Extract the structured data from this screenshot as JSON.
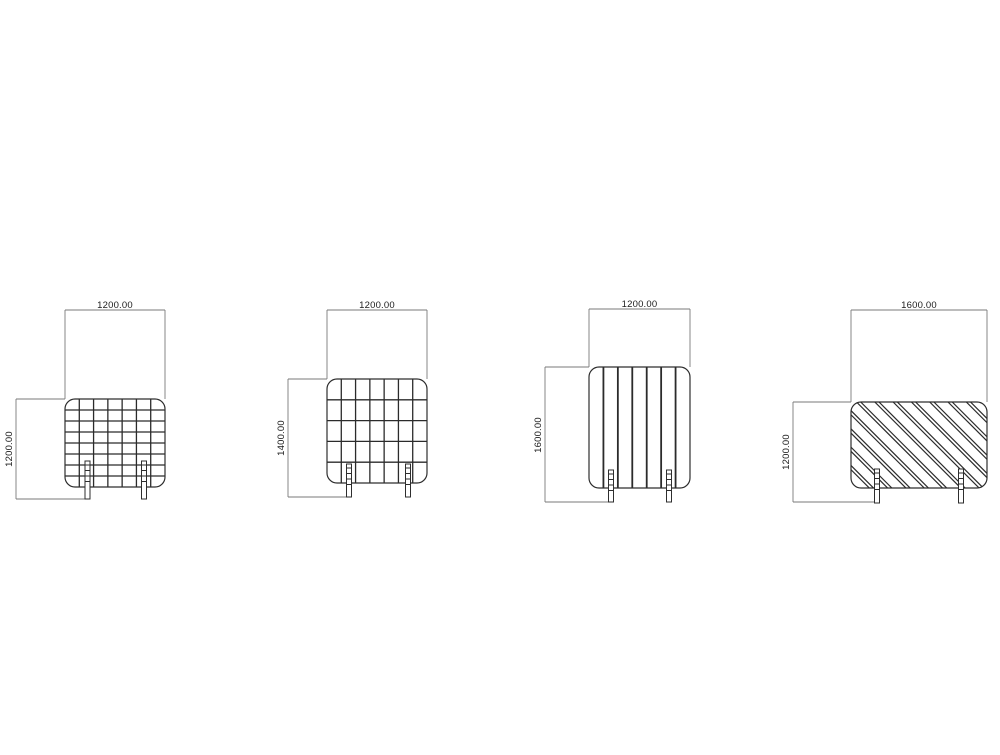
{
  "drawing": {
    "title": "partition-screen-elevations",
    "canvas": {
      "width": 1000,
      "height": 755,
      "background": "#ffffff"
    },
    "colors": {
      "object_line": "#2e2e2e",
      "pattern_line": "#2b2b2b",
      "dimension_line": "#7a7a7a",
      "text": "#1b1b1b",
      "fill": "#ffffff"
    },
    "panels": [
      {
        "name": "panel-1-square-grid",
        "pattern": "grid",
        "grid": {
          "cols": 7,
          "rows": 8
        },
        "body": {
          "x": 65,
          "y": 399,
          "w": 100,
          "h": 88,
          "rx": 10
        },
        "feet": {
          "xs": [
            87.5,
            144
          ],
          "top": 461,
          "bottom": 499,
          "w": 5
        },
        "width_dim": {
          "label": "1200.00",
          "y": 310,
          "x1": 65,
          "x2": 165
        },
        "height_dim": {
          "label": "1200.00",
          "x": 16,
          "y1": 399,
          "y2": 499,
          "top_ext": 65,
          "bottom_ext": 88,
          "label_cy": 449
        }
      },
      {
        "name": "panel-2-tall-grid",
        "pattern": "grid",
        "grid": {
          "cols": 7,
          "rows": 5
        },
        "body": {
          "x": 327,
          "y": 379,
          "w": 100,
          "h": 104,
          "rx": 10
        },
        "feet": {
          "xs": [
            349,
            408
          ],
          "top": 464,
          "bottom": 497,
          "w": 5
        },
        "width_dim": {
          "label": "1200.00",
          "y": 310,
          "x1": 327,
          "x2": 427
        },
        "height_dim": {
          "label": "1400.00",
          "x": 288,
          "y1": 379,
          "y2": 497,
          "top_ext": 327,
          "bottom_ext": 350,
          "label_cy": 438
        }
      },
      {
        "name": "panel-3-vertical-slats",
        "pattern": "slats",
        "grid": {
          "cols": 7
        },
        "body": {
          "x": 589,
          "y": 367,
          "w": 101,
          "h": 121,
          "rx": 10
        },
        "feet": {
          "xs": [
            611,
            669
          ],
          "top": 470,
          "bottom": 502,
          "w": 5
        },
        "width_dim": {
          "label": "1200.00",
          "y": 309,
          "x1": 589,
          "x2": 690
        },
        "height_dim": {
          "label": "1600.00",
          "x": 545,
          "y1": 367,
          "y2": 502,
          "top_ext": 589,
          "bottom_ext": 611,
          "label_cy": 435
        }
      },
      {
        "name": "panel-4-diagonal-hatch",
        "pattern": "diagonal",
        "hatch": {
          "period": 18.3,
          "pair_gap": 4.2
        },
        "body": {
          "x": 851,
          "y": 402,
          "w": 136,
          "h": 86,
          "rx": 10
        },
        "feet": {
          "xs": [
            877,
            961
          ],
          "top": 469,
          "bottom": 503,
          "w": 5
        },
        "width_dim": {
          "label": "1600.00",
          "y": 310,
          "x1": 851,
          "x2": 987
        },
        "height_dim": {
          "label": "1200.00",
          "x": 793,
          "y1": 402,
          "y2": 502,
          "top_ext": 851,
          "bottom_ext": 878,
          "label_cy": 452
        }
      }
    ]
  }
}
